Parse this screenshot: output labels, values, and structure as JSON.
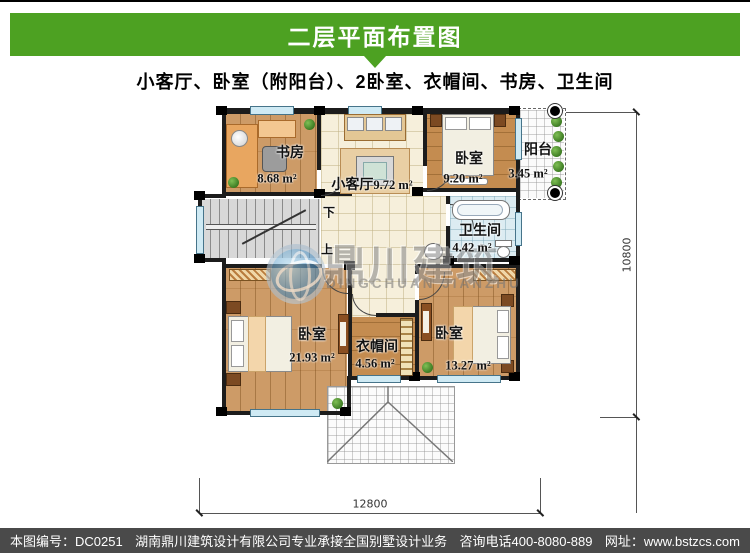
{
  "header": {
    "title": "二层平面布置图",
    "subtitle": "小客厅、卧室（附阳台）、2卧室、衣帽间、书房、卫生间"
  },
  "plan": {
    "rooms": [
      {
        "name": "书房",
        "area": "8.68 m²"
      },
      {
        "name": "小客厅",
        "area": "9.72 m²"
      },
      {
        "name": "卧室",
        "area": "9.20 m²"
      },
      {
        "name": "阳台",
        "area": "3.45 m²"
      },
      {
        "name": "卫生间",
        "area": "4.42 m²"
      },
      {
        "name": "卧室",
        "area": "21.93 m²"
      },
      {
        "name": "衣帽间",
        "area": "4.56 m²"
      },
      {
        "name": "卧室",
        "area": "13.27 m²"
      }
    ],
    "stairs": {
      "down": "下",
      "up": "上"
    },
    "dimensions": {
      "bottom": "12800",
      "right": "10800"
    }
  },
  "watermark": {
    "cn": "鼎川建筑",
    "en": "DINGCHUAN JIANZHU"
  },
  "footer": {
    "serial": "本图编号：DC0251",
    "company": "湖南鼎川建筑设计有限公司专业承接全国别墅设计业务",
    "phone": "咨询电话400-8080-889",
    "website": "网址：www.bstzcs.com"
  },
  "colors": {
    "header_green": "#4da122",
    "footer_gray": "#4a4a4a",
    "wood": "#c9935a",
    "tile": "#f6efdb"
  }
}
